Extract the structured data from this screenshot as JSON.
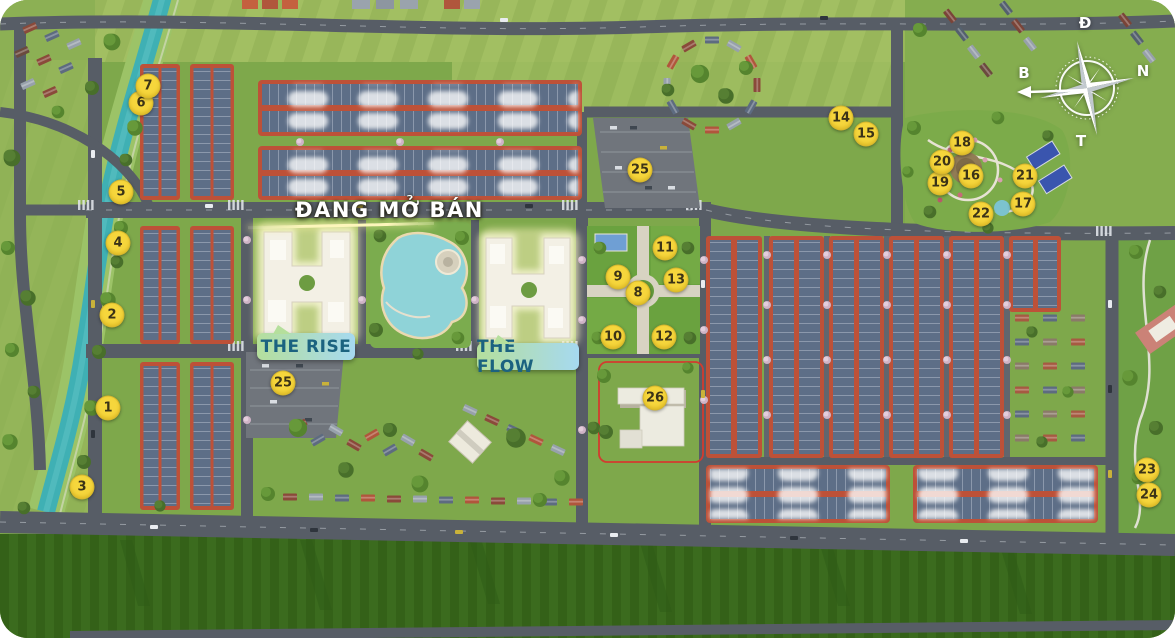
{
  "banner": {
    "text": "ĐANG MỞ BÁN"
  },
  "zones": {
    "rise": "THE RISE",
    "flow": "THE FLOW"
  },
  "compass": {
    "top": "Đ",
    "right": "N",
    "left": "B",
    "bottom": "T"
  },
  "markers": [
    {
      "n": "1",
      "x": 108,
      "y": 408
    },
    {
      "n": "2",
      "x": 112,
      "y": 315
    },
    {
      "n": "3",
      "x": 82,
      "y": 487
    },
    {
      "n": "4",
      "x": 118,
      "y": 243
    },
    {
      "n": "5",
      "x": 121,
      "y": 192
    },
    {
      "n": "6",
      "x": 141,
      "y": 103
    },
    {
      "n": "7",
      "x": 148,
      "y": 86
    },
    {
      "n": "8",
      "x": 638,
      "y": 293
    },
    {
      "n": "9",
      "x": 618,
      "y": 277
    },
    {
      "n": "10",
      "x": 613,
      "y": 337
    },
    {
      "n": "11",
      "x": 665,
      "y": 248
    },
    {
      "n": "12",
      "x": 664,
      "y": 337
    },
    {
      "n": "13",
      "x": 676,
      "y": 280
    },
    {
      "n": "14",
      "x": 841,
      "y": 118
    },
    {
      "n": "15",
      "x": 866,
      "y": 134
    },
    {
      "n": "16",
      "x": 971,
      "y": 176
    },
    {
      "n": "17",
      "x": 1023,
      "y": 204
    },
    {
      "n": "18",
      "x": 962,
      "y": 143
    },
    {
      "n": "19",
      "x": 940,
      "y": 183
    },
    {
      "n": "20",
      "x": 942,
      "y": 162
    },
    {
      "n": "21",
      "x": 1025,
      "y": 176
    },
    {
      "n": "22",
      "x": 981,
      "y": 214
    },
    {
      "n": "23",
      "x": 1147,
      "y": 470
    },
    {
      "n": "24",
      "x": 1149,
      "y": 495
    },
    {
      "n": "25",
      "x": 640,
      "y": 170
    },
    {
      "n": "25",
      "x": 283,
      "y": 383
    },
    {
      "n": "26",
      "x": 655,
      "y": 398
    }
  ],
  "colors": {
    "marker_bg": "#F6D63C",
    "marker_text": "#3B3317",
    "banner_text": "#FFFFFF",
    "zone_label_text": "#1B6280",
    "zone_label_gradient_start": "#B5DF9C",
    "zone_label_gradient_end": "#A6D9F0",
    "river": "#3FB0B4",
    "lagoon": "#8FD3D8",
    "highlight_glow": "#FCF4BC",
    "roof_red": "#BD5138",
    "roof_panel": "#5D6E87",
    "road_gray": "#575D66",
    "grass_green": "#7EA84B",
    "crop_field_green": "#3B6B1E"
  }
}
